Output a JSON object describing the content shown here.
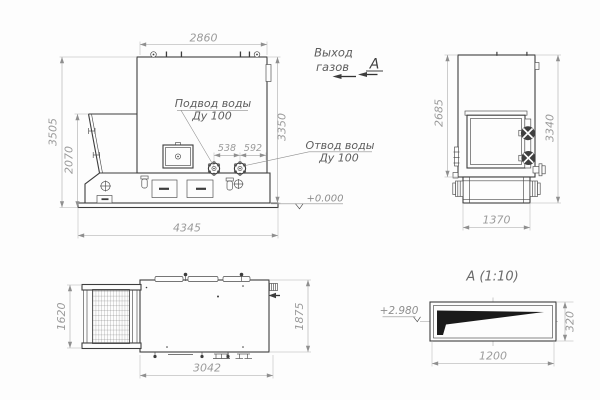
{
  "labels": {
    "gas_outlet_line1": "Выход",
    "gas_outlet_line2": "газов",
    "section_letter": "А",
    "water_inlet_line1": "Подвод воды",
    "water_inlet_line2": "Ду 100",
    "water_outlet_line1": "Отвод воды",
    "water_outlet_line2": "Ду 100",
    "level_zero": "+0.000",
    "section_title": "А (1:10)",
    "section_level": "+2.980"
  },
  "dimensions": {
    "front": {
      "width_top": "2860",
      "height_overall": "3505",
      "hopper_height": "2070",
      "height_right": "3350",
      "base_width": "4345",
      "nozzle_span_left": "538",
      "nozzle_span_right": "592"
    },
    "side": {
      "body_height": "2685",
      "overall_height": "3340",
      "base_width": "1370"
    },
    "top": {
      "hopper_width": "1620",
      "body_width": "1875",
      "body_length": "3042"
    },
    "section": {
      "duct_width": "1200",
      "duct_height": "320"
    }
  },
  "colors": {
    "line": "#3d3d3d",
    "dimension": "#a4a4a4",
    "label": "#5d5d5d",
    "background": "#fdfdfd"
  }
}
